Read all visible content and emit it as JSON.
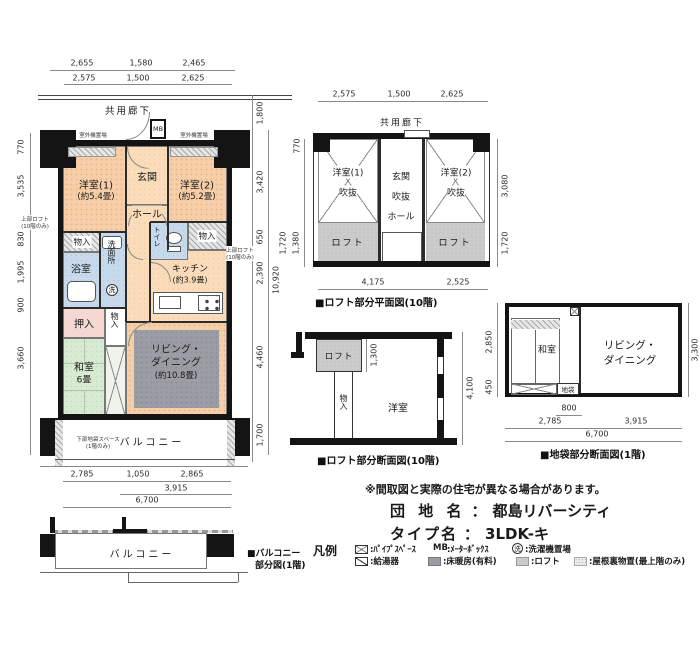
{
  "colors": {
    "western_room": "#f6cfa9",
    "floor": "#fbdcba",
    "wet_area": "#c6daec",
    "tatami": "#d9ead3",
    "closet_pink": "#f6d8d2",
    "floor_heating": "#9c9ca4",
    "loft": "#cbcbcb",
    "wall": "#141414"
  },
  "main": {
    "corridor": "共用廊下",
    "dims": {
      "top1": [
        "2,655",
        "1,580",
        "2,465"
      ],
      "top2": [
        "2,575",
        "1,500",
        "2,625"
      ],
      "left": [
        "770",
        "3,535",
        "830",
        "1,995",
        "900",
        "3,660"
      ],
      "right": [
        "1,800",
        "3,420",
        "650",
        "2,390",
        "4,460",
        "1,700"
      ],
      "right_total": "10,920",
      "bottom1": [
        "2,785",
        "1,050",
        "2,865"
      ],
      "bottom2": "3,915",
      "bottom3": "6,700"
    },
    "rooms": {
      "mb": "MB",
      "entrance": "玄関",
      "w1": "洋室(1)",
      "w1s": "(約5.4畳)",
      "w2": "洋室(2)",
      "w2s": "(約5.2畳)",
      "hall": "ホール",
      "storage_l": "物入",
      "storage_r": "物入",
      "storage_c": "物入",
      "washroom": "洗面所",
      "washer_mark": "洗",
      "bath": "浴室",
      "toilet": "トイレ",
      "kitchen": "キッチン",
      "kitchens": "(約3.9畳)",
      "oshiire": "押入",
      "washitsu": "和室",
      "washitsus": "6畳",
      "living1": "リビング・",
      "living2": "ダイニング",
      "livings": "(約10.8畳)",
      "balcony": "バルコニー"
    },
    "notes": {
      "outdoor1": "室外機置場",
      "outdoor2": "室外機置場",
      "upper_loft_l1": "上部ロフト",
      "upper_loft_l2": "(10階のみ)",
      "upper_loft_r1": "上部ロフト",
      "upper_loft_r2": "(10階のみ)",
      "jibukuro1": "下部地袋スペース",
      "jibukuro2": "(1階のみ)"
    }
  },
  "loftplan": {
    "corridor": "共用廊下",
    "dims": {
      "top": [
        "2,575",
        "1,500",
        "2,625"
      ],
      "left_top": "770",
      "left_out": "1,720",
      "left_in": "1,380",
      "right_top": "3,080",
      "right_bottom": "1,720",
      "bottom": [
        "4,175",
        "2,525"
      ]
    },
    "rooms": {
      "w1": "洋室(1)",
      "w1b": "吹抜",
      "genkan": "玄関",
      "genkanb": "吹抜",
      "hall": "ホール",
      "w2": "洋室(2)",
      "w2b": "吹抜",
      "loft1": "ロフト",
      "loft2": "ロフト"
    },
    "caption": "■ロフト部分平面図(10階)"
  },
  "loftsec": {
    "rooms": {
      "loft": "ロフト",
      "storage": "物入",
      "western": "洋室"
    },
    "dims": {
      "loft_h": "1,300",
      "total_h": "4,100"
    },
    "caption": "■ロフト部分断面図(10階)"
  },
  "jibukuro": {
    "rooms": {
      "washitsu": "和室",
      "living1": "リビング・",
      "living2": "ダイニング",
      "jibukuro": "地袋"
    },
    "dims": {
      "left_top": "2,850",
      "left_bottom": "450",
      "right": "3,300",
      "b800": "800",
      "b2785": "2,785",
      "b3915": "3,915",
      "b6700": "6,700"
    },
    "caption": "■地袋部分断面図(1階)"
  },
  "balconyfig": {
    "label": "バルコニー",
    "caption1": "■バルコニー",
    "caption2": "部分図(1階)"
  },
  "legend": {
    "title": "凡例",
    "pipe": ":ﾊﾟｲﾌﾟｽﾍﾟｰｽ",
    "mb_abbr": "MB",
    "mb": ":ﾒｰﾀｰﾎﾞｯｸｽ",
    "washer_abbr": "洗",
    "washer": ":洗濯機置場",
    "heater": ":給湯器",
    "floor_heating": ":床暖房(有料)",
    "loft": ":ロフト",
    "attic": ":屋根裏物置(最上階のみ)"
  },
  "doc": {
    "disclaimer": "※間取図と実際の住宅が異なる場合があります。",
    "estate_label": "団 地 名",
    "estate_colon": "：",
    "estate_name": "都島リバーシティ",
    "type_label": "タイプ名",
    "type_colon": "：",
    "type_name": "3LDK-キ"
  }
}
